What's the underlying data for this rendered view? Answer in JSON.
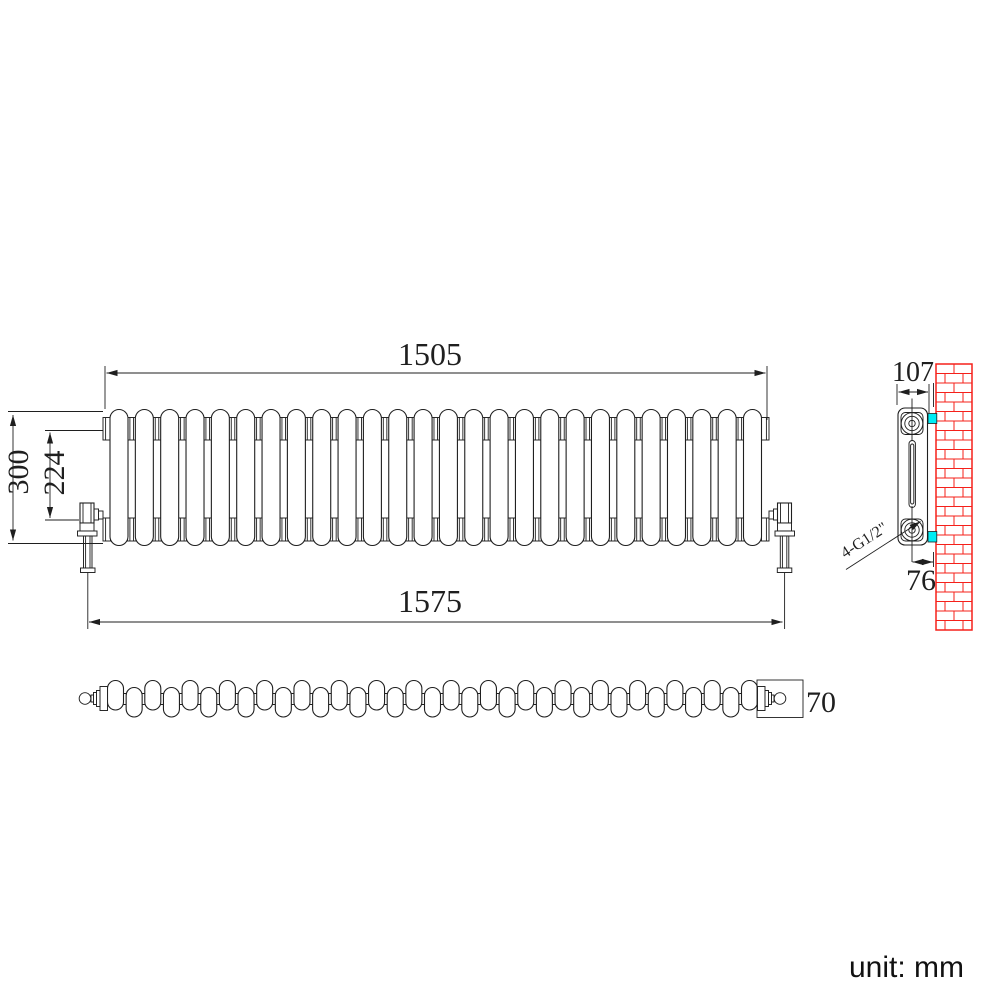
{
  "drawing": {
    "unit_note": "unit: mm",
    "dimensions": {
      "overall_width": "1505",
      "valve_to_valve_width": "1575",
      "height": "300",
      "pipe_centres_height": "224",
      "section_depth": "107",
      "wall_to_pipe_centre": "76",
      "top_depth": "70",
      "connections": "4-G1/2\""
    },
    "front_view": {
      "column_count": 26
    },
    "top_view": {
      "capsule_count": 35
    },
    "wall": {
      "brick_rows": 28
    },
    "colors": {
      "line": "#1f1f1f",
      "brick_red": "#f5201a",
      "bracket_cyan": "#00ecf4",
      "background": "#ffffff"
    }
  }
}
